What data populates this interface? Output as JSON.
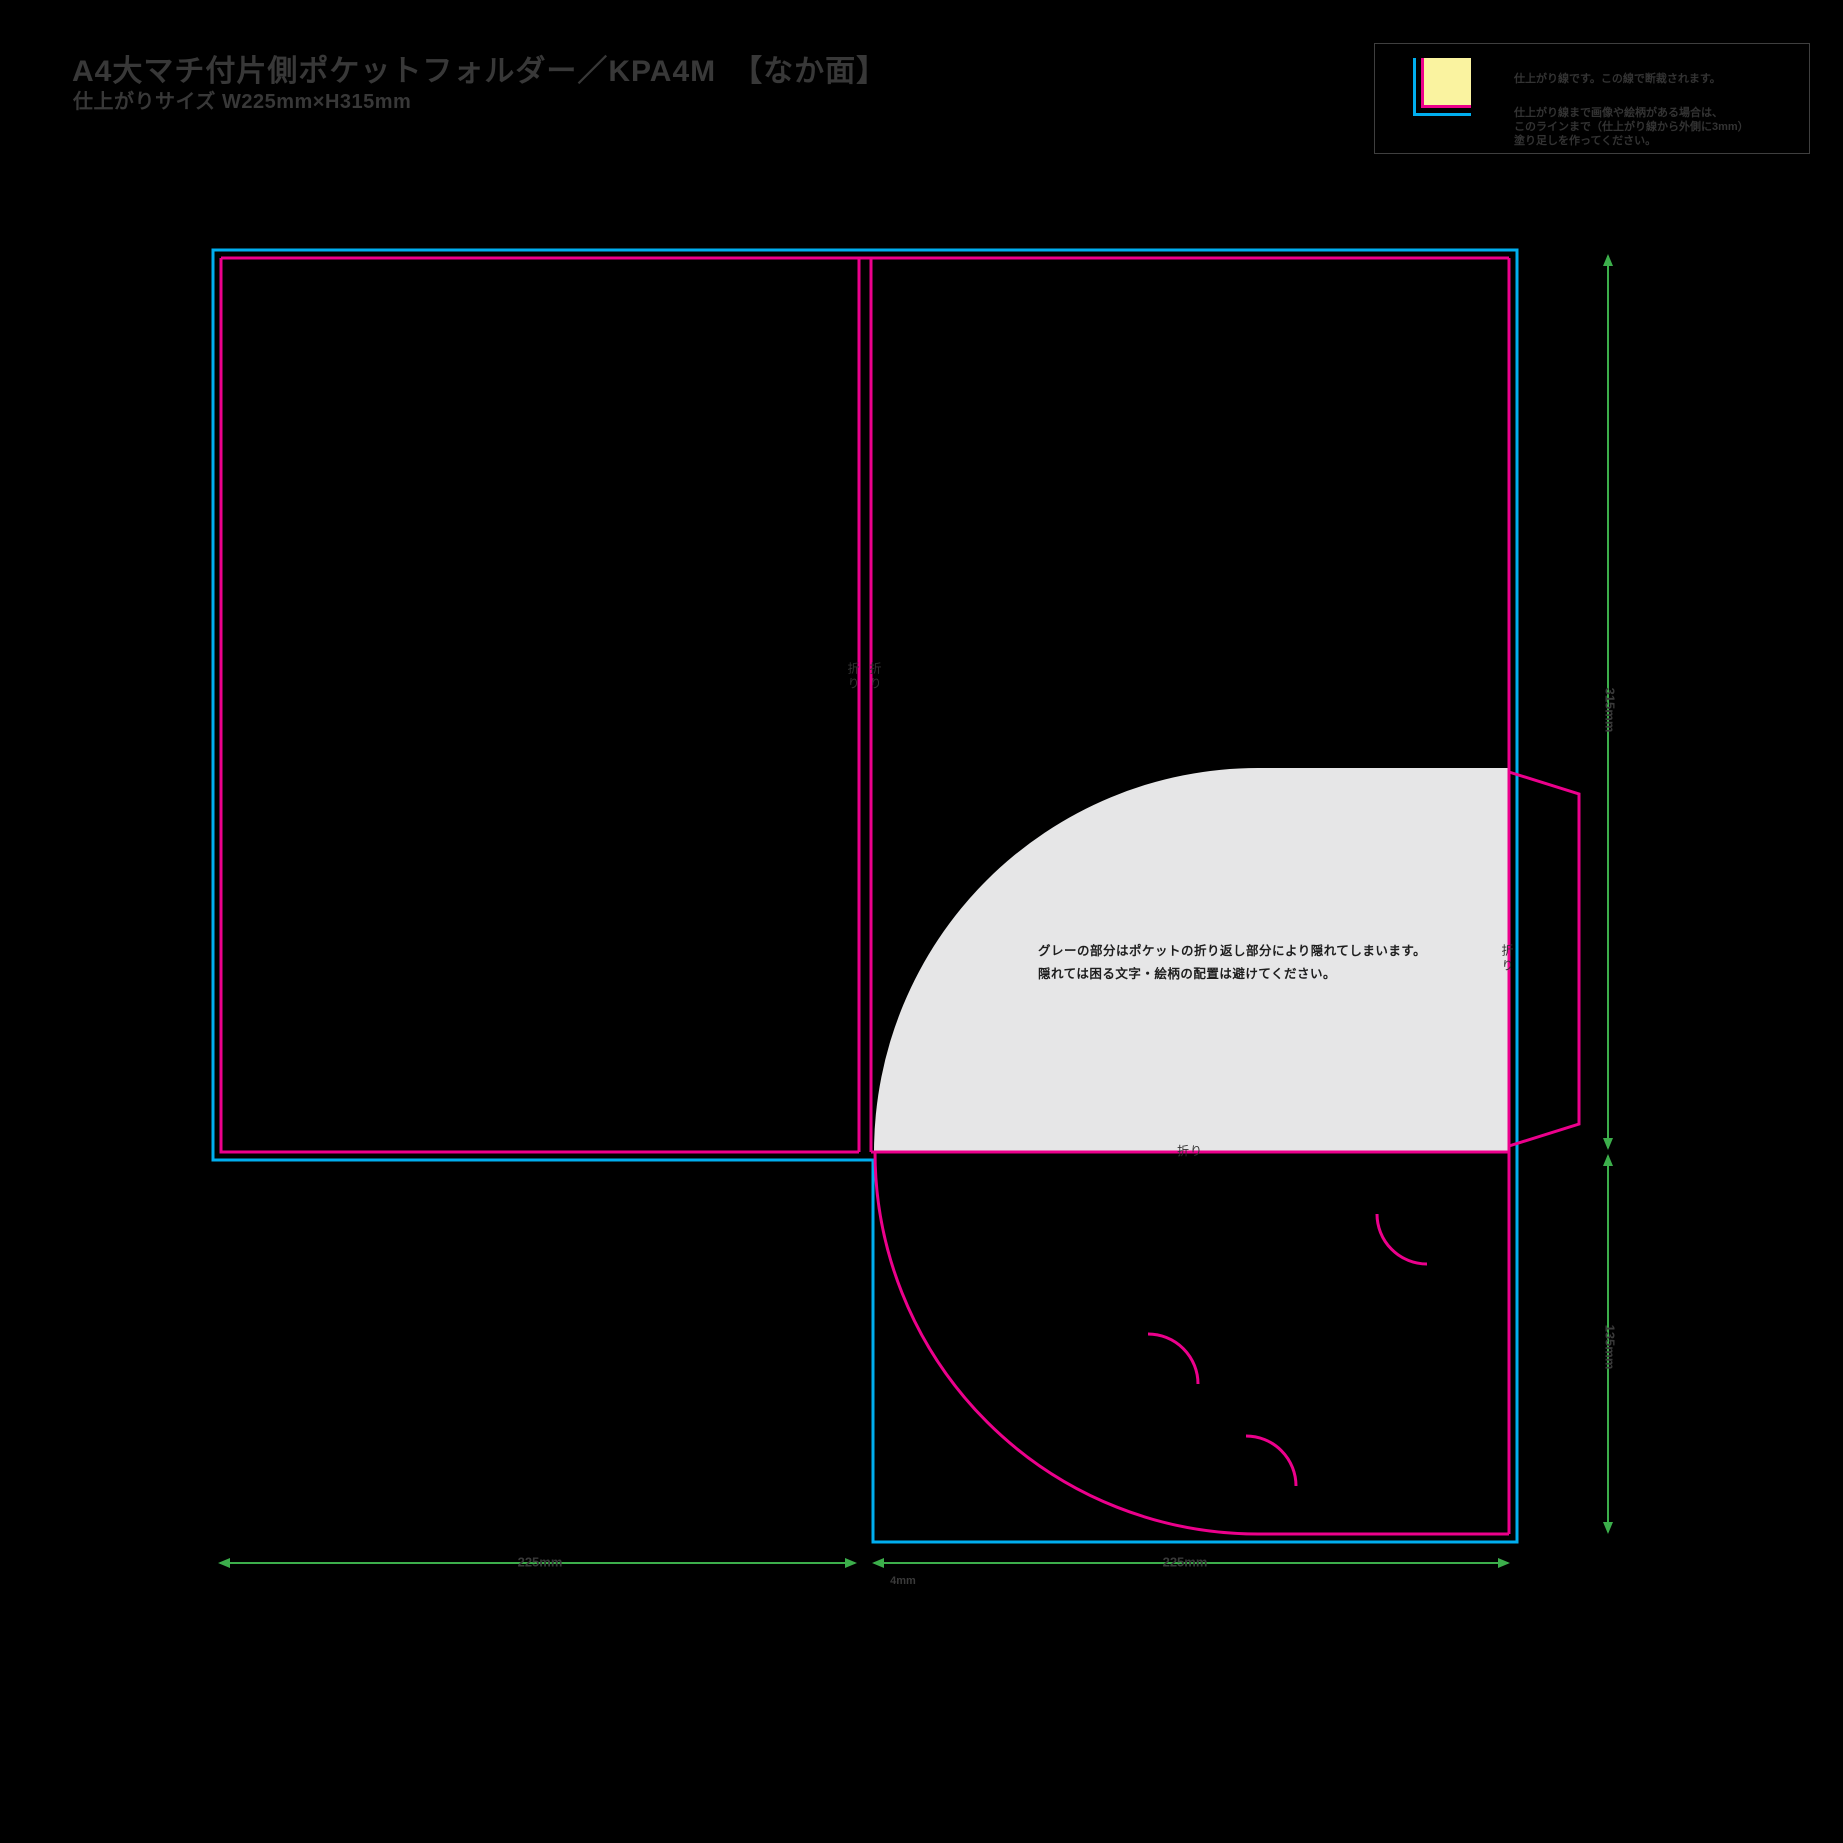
{
  "header": {
    "title": "A4大マチ付片側ポケットフォルダー／KPA4M　【なか面】",
    "subtitle": "仕上がりサイズ W225mm×H315mm"
  },
  "legend": {
    "note_cut": "仕上がり線です。この線で断裁されます。",
    "note_bleed_line1": "仕上がり線まで画像や絵柄がある場合は、",
    "note_bleed_line2": "このラインまで（仕上がり線から外側に3mm）",
    "note_bleed_line3": "塗り足しを作ってください。",
    "swatch_color": "#FAF3A0"
  },
  "colors": {
    "cut_line": "#00AEEF",
    "finish_line": "#EC008C",
    "dimension_line": "#3CAE4B",
    "hidden_area_fill": "#E6E6E7",
    "label_text": "#383838"
  },
  "gray_note": {
    "line1": "グレーの部分はポケットの折り返し部分により隠れてしまいます。",
    "line2": "隠れては困る文字・絵柄の配置は避けてください。"
  },
  "fold_labels": {
    "spine_left": "折り",
    "spine_right": "折り",
    "flap": "折り",
    "pocket": "折り"
  },
  "dimensions": {
    "width_left": "225mm",
    "width_right": "225mm",
    "spine_width": "4mm",
    "height_main": "315mm",
    "height_pocket": "135mm"
  }
}
